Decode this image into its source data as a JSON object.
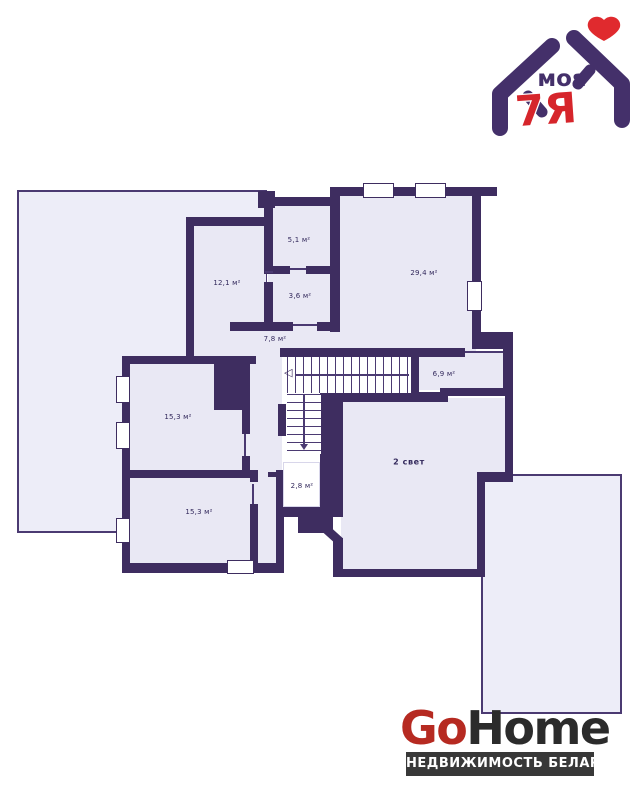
{
  "brand_logo": {
    "word": "моя",
    "mark": "7Я",
    "purple": "#44306a",
    "red": "#d6252b",
    "heart_color": "#e02a2e"
  },
  "plan": {
    "wall_color": "#3e2d60",
    "room_fill": "#e9e8f4",
    "outline_fill": "#ededf8",
    "rooms": [
      {
        "id": "room-12-1",
        "label": "12,1 м²"
      },
      {
        "id": "room-5-1",
        "label": "5,1 м²"
      },
      {
        "id": "room-3-6",
        "label": "3,6 м²"
      },
      {
        "id": "room-29-4",
        "label": "29,4 м²"
      },
      {
        "id": "room-7-8",
        "label": "7,8 м²"
      },
      {
        "id": "room-6-9",
        "label": "6,9 м²"
      },
      {
        "id": "room-15-3-upper",
        "label": "15,3 м²"
      },
      {
        "id": "room-15-3-lower",
        "label": "15,3 м²"
      },
      {
        "id": "room-2-8",
        "label": "2,8 м²"
      },
      {
        "id": "room-2svet",
        "label": "2 свет"
      }
    ]
  },
  "footer_logo": {
    "go": "Go",
    "home": "Home",
    "tagline": "НЕДВИЖИМОСТЬ БЕЛАРУСИ",
    "red": "#b62a21",
    "dark": "#2b2b2b",
    "banner_bg": "#383838"
  }
}
